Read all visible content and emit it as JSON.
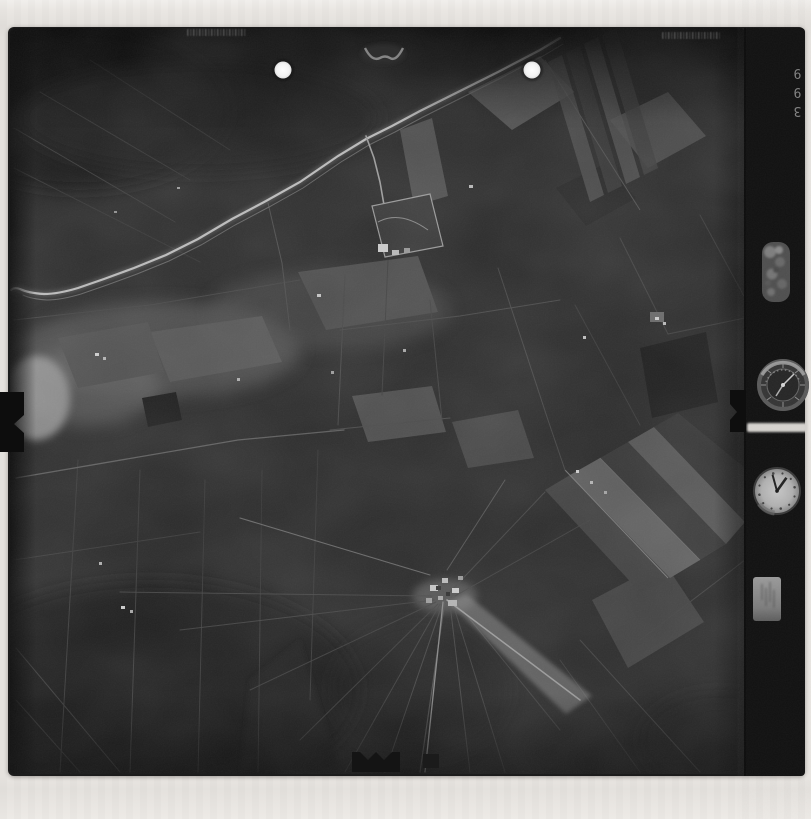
{
  "film": {
    "frame_number": "399"
  },
  "colors": {
    "paper": "#eae7e3",
    "paper-band": "#dcd8d4",
    "film": "#1c1c1c",
    "photo-base": "#2c2c2c",
    "road-highlight": "#bdbdbd",
    "punch-hole": "#f4f4f4",
    "frame-number-color": "#8f8f8f"
  },
  "icons": {
    "punch-hole": "white circle",
    "fiducial-notch": "black tab with v-notch",
    "collimation-mark": "light chevron",
    "clock-dial": "analog clock face",
    "altimeter-dial": "round instrument dial",
    "counter-window": "mottled round window",
    "id-plate": "light rectangular plate"
  }
}
